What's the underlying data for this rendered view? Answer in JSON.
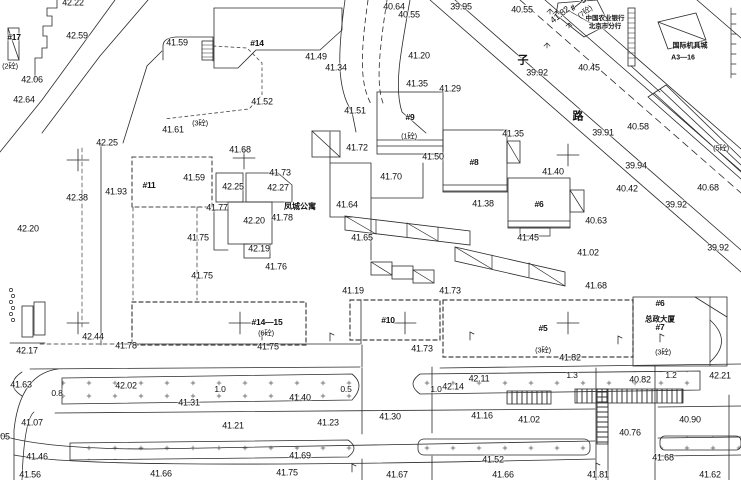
{
  "meta": {
    "drawing_type": "topographic-site-plan",
    "canvas": {
      "width": 741,
      "height": 480
    },
    "colors": {
      "ink": "#2a2a2a",
      "boundary": "#3a3a3a",
      "text": "#111111",
      "paper": "#ffffff"
    }
  },
  "street": {
    "name_chars": [
      {
        "t": "子",
        "x": 523,
        "y": 61
      },
      {
        "t": "路",
        "x": 578,
        "y": 117
      }
    ]
  },
  "places": [
    {
      "t": "凤城公寓",
      "x": 300,
      "y": 207,
      "size": 8
    },
    {
      "t": "总政大厦",
      "x": 660,
      "y": 319,
      "size": 7.5
    },
    {
      "t": "中国农业银行",
      "x": 605,
      "y": 19,
      "size": 6.5
    },
    {
      "t": "北京市分行",
      "x": 605,
      "y": 27,
      "size": 6.5
    },
    {
      "t": "国际机具城",
      "x": 690,
      "y": 46,
      "size": 7
    },
    {
      "t": "A3—16",
      "x": 683,
      "y": 58,
      "size": 7
    }
  ],
  "buildings": [
    {
      "t": "#17",
      "x": 14,
      "y": 37
    },
    {
      "t": "#14",
      "x": 257,
      "y": 43
    },
    {
      "t": "#11",
      "x": 149,
      "y": 185
    },
    {
      "t": "#9",
      "x": 410,
      "y": 117
    },
    {
      "t": "#8",
      "x": 474,
      "y": 162
    },
    {
      "t": "#6",
      "x": 539,
      "y": 204
    },
    {
      "t": "#14—15",
      "x": 267,
      "y": 322
    },
    {
      "t": "#10",
      "x": 388,
      "y": 320
    },
    {
      "t": "#5",
      "x": 543,
      "y": 328
    },
    {
      "t": "#6",
      "x": 660,
      "y": 303
    },
    {
      "t": "#7",
      "x": 660,
      "y": 327
    },
    {
      "t": "#—5",
      "x": 578,
      "y": 4,
      "rot": -38
    }
  ],
  "floor_notes": [
    {
      "t": "(2砼)",
      "x": 10,
      "y": 66
    },
    {
      "t": "(3砼)",
      "x": 200,
      "y": 123
    },
    {
      "t": "(1砼)",
      "x": 409,
      "y": 136
    },
    {
      "t": "(7砼)",
      "x": 585,
      "y": 12,
      "rot": -38
    },
    {
      "t": "(6砼)",
      "x": 266,
      "y": 333
    },
    {
      "t": "(3砼)",
      "x": 543,
      "y": 350
    },
    {
      "t": "(3砼)",
      "x": 663,
      "y": 352
    },
    {
      "t": "(5砼)",
      "x": 721,
      "y": 148
    }
  ],
  "elevations": [
    {
      "x": 73,
      "y": 3,
      "t": "42.22"
    },
    {
      "x": 77,
      "y": 36,
      "t": "42.59"
    },
    {
      "x": 177,
      "y": 43,
      "t": "41.59"
    },
    {
      "x": 32,
      "y": 80,
      "t": "42.06"
    },
    {
      "x": 24,
      "y": 100,
      "t": "42.64"
    },
    {
      "x": 107,
      "y": 143,
      "t": "42.25"
    },
    {
      "x": 173,
      "y": 130,
      "t": "41.61"
    },
    {
      "x": 116,
      "y": 192,
      "t": "41.93"
    },
    {
      "x": 77,
      "y": 198,
      "t": "42.38"
    },
    {
      "x": 28,
      "y": 229,
      "t": "42.20"
    },
    {
      "x": 316,
      "y": 57,
      "t": "41.49"
    },
    {
      "x": 262,
      "y": 102,
      "t": "41.52"
    },
    {
      "x": 355,
      "y": 111,
      "t": "41.51"
    },
    {
      "x": 394,
      "y": 7,
      "t": "40.64"
    },
    {
      "x": 409,
      "y": 15,
      "t": "40.55"
    },
    {
      "x": 461,
      "y": 7,
      "t": "39.95"
    },
    {
      "x": 336,
      "y": 68,
      "t": "41.34"
    },
    {
      "x": 419,
      "y": 56,
      "t": "41.20"
    },
    {
      "x": 417,
      "y": 84,
      "t": "41.35"
    },
    {
      "x": 450,
      "y": 89,
      "t": "41.29"
    },
    {
      "x": 522,
      "y": 10,
      "t": "40.55"
    },
    {
      "x": 560,
      "y": 15,
      "t": "41.82",
      "rot": -38
    },
    {
      "x": 537,
      "y": 73,
      "t": "39.92"
    },
    {
      "x": 589,
      "y": 68,
      "t": "40.45"
    },
    {
      "x": 638,
      "y": 127,
      "t": "40.58"
    },
    {
      "x": 603,
      "y": 133,
      "t": "39.91"
    },
    {
      "x": 513,
      "y": 134,
      "t": "41.35"
    },
    {
      "x": 240,
      "y": 150,
      "t": "41.68"
    },
    {
      "x": 280,
      "y": 173,
      "t": "41.73"
    },
    {
      "x": 194,
      "y": 178,
      "t": "41.59"
    },
    {
      "x": 233,
      "y": 187,
      "t": "42.25"
    },
    {
      "x": 278,
      "y": 188,
      "t": "42.27"
    },
    {
      "x": 217,
      "y": 208,
      "t": "41.77"
    },
    {
      "x": 254,
      "y": 221,
      "t": "42.20"
    },
    {
      "x": 282,
      "y": 218,
      "t": "41.78"
    },
    {
      "x": 198,
      "y": 238,
      "t": "41.75"
    },
    {
      "x": 259,
      "y": 249,
      "t": "42.19"
    },
    {
      "x": 276,
      "y": 267,
      "t": "41.76"
    },
    {
      "x": 202,
      "y": 276,
      "t": "41.75"
    },
    {
      "x": 357,
      "y": 148,
      "t": "41.72"
    },
    {
      "x": 433,
      "y": 157,
      "t": "41.50"
    },
    {
      "x": 391,
      "y": 177,
      "t": "41.70"
    },
    {
      "x": 347,
      "y": 205,
      "t": "41.64"
    },
    {
      "x": 483,
      "y": 204,
      "t": "41.38"
    },
    {
      "x": 362,
      "y": 238,
      "t": "41.65"
    },
    {
      "x": 553,
      "y": 172,
      "t": "41.40"
    },
    {
      "x": 636,
      "y": 166,
      "t": "39.94"
    },
    {
      "x": 627,
      "y": 189,
      "t": "40.42"
    },
    {
      "x": 708,
      "y": 188,
      "t": "40.68"
    },
    {
      "x": 676,
      "y": 205,
      "t": "39.92"
    },
    {
      "x": 596,
      "y": 221,
      "t": "40.63"
    },
    {
      "x": 718,
      "y": 248,
      "t": "39.92"
    },
    {
      "x": 528,
      "y": 238,
      "t": "41.45"
    },
    {
      "x": 588,
      "y": 253,
      "t": "41.02"
    },
    {
      "x": 596,
      "y": 286,
      "t": "41.68"
    },
    {
      "x": 353,
      "y": 291,
      "t": "41.19"
    },
    {
      "x": 450,
      "y": 291,
      "t": "41.73"
    },
    {
      "x": 93,
      "y": 337,
      "t": "42.44"
    },
    {
      "x": 27,
      "y": 351,
      "t": "42.17"
    },
    {
      "x": 126,
      "y": 346,
      "t": "41.78"
    },
    {
      "x": 268,
      "y": 347,
      "t": "41.75"
    },
    {
      "x": 422,
      "y": 349,
      "t": "41.73"
    },
    {
      "x": 570,
      "y": 358,
      "t": "41.82"
    },
    {
      "x": 21,
      "y": 385,
      "t": "41.63"
    },
    {
      "x": 126,
      "y": 386,
      "t": "42.02"
    },
    {
      "x": 189,
      "y": 403,
      "t": "41.31"
    },
    {
      "x": 300,
      "y": 398,
      "t": "41.40"
    },
    {
      "x": 453,
      "y": 387,
      "t": "42.14"
    },
    {
      "x": 479,
      "y": 379,
      "t": "42.11"
    },
    {
      "x": 640,
      "y": 380,
      "t": "40.82"
    },
    {
      "x": 720,
      "y": 376,
      "t": "42.21"
    },
    {
      "x": 32,
      "y": 423,
      "t": "41.07"
    },
    {
      "x": 233,
      "y": 426,
      "t": "41.21"
    },
    {
      "x": 328,
      "y": 423,
      "t": "41.23"
    },
    {
      "x": 390,
      "y": 417,
      "t": "41.30"
    },
    {
      "x": 482,
      "y": 416,
      "t": "41.16"
    },
    {
      "x": 529,
      "y": 420,
      "t": "41.02"
    },
    {
      "x": 690,
      "y": 420,
      "t": "40.90"
    },
    {
      "x": 630,
      "y": 433,
      "t": "40.76"
    },
    {
      "x": 5,
      "y": 437,
      "t": "05"
    },
    {
      "x": 37,
      "y": 457,
      "t": "41.46"
    },
    {
      "x": 300,
      "y": 456,
      "t": "41.69"
    },
    {
      "x": 493,
      "y": 460,
      "t": "41.52"
    },
    {
      "x": 663,
      "y": 458,
      "t": "41.68"
    },
    {
      "x": 30,
      "y": 475,
      "t": "41.56"
    },
    {
      "x": 161,
      "y": 474,
      "t": "41.66"
    },
    {
      "x": 287,
      "y": 473,
      "t": "41.75"
    },
    {
      "x": 397,
      "y": 475,
      "t": "41.67"
    },
    {
      "x": 503,
      "y": 475,
      "t": "41.66"
    },
    {
      "x": 598,
      "y": 475,
      "t": "41.81"
    },
    {
      "x": 710,
      "y": 475,
      "t": "41.62"
    }
  ],
  "dimensions": [
    {
      "x": 57,
      "y": 393,
      "t": "0.8"
    },
    {
      "x": 220,
      "y": 389,
      "t": "1.0"
    },
    {
      "x": 346,
      "y": 389,
      "t": "0.5"
    },
    {
      "x": 436,
      "y": 389,
      "t": "1.0"
    },
    {
      "x": 572,
      "y": 375,
      "t": "1.3"
    },
    {
      "x": 671,
      "y": 375,
      "t": "1.2"
    }
  ],
  "marks": {
    "survey_crosses": [
      {
        "x": 78,
        "y": 160
      },
      {
        "x": 244,
        "y": 158
      },
      {
        "x": 568,
        "y": 155
      },
      {
        "x": 78,
        "y": 323
      },
      {
        "x": 240,
        "y": 323
      },
      {
        "x": 405,
        "y": 323
      },
      {
        "x": 568,
        "y": 323
      }
    ],
    "trees": [
      {
        "x": 550,
        "y": 10
      },
      {
        "x": 556,
        "y": 12
      },
      {
        "x": 569,
        "y": 24
      },
      {
        "x": 547,
        "y": 44
      }
    ],
    "lamps": [
      {
        "x": 262,
        "y": 340
      },
      {
        "x": 330,
        "y": 341
      },
      {
        "x": 470,
        "y": 340
      },
      {
        "x": 618,
        "y": 344
      },
      {
        "x": 660,
        "y": 342
      },
      {
        "x": 352,
        "y": 472
      },
      {
        "x": 596,
        "y": 471
      }
    ]
  }
}
